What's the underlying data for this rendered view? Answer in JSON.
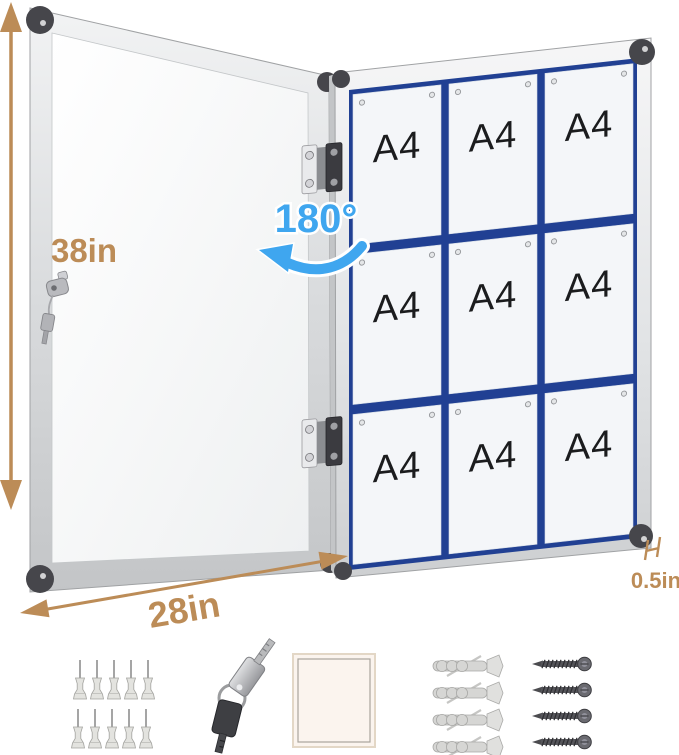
{
  "dimensions": {
    "height_label": "38in",
    "width_label": "28in",
    "depth_label": "0.5in",
    "door_swing_label": "180°"
  },
  "board": {
    "rows": 3,
    "columns": 3,
    "cells": [
      {
        "label": "A4"
      },
      {
        "label": "A4"
      },
      {
        "label": "A4"
      },
      {
        "label": "A4"
      },
      {
        "label": "A4"
      },
      {
        "label": "A4"
      },
      {
        "label": "A4"
      },
      {
        "label": "A4"
      },
      {
        "label": "A4"
      }
    ]
  },
  "accessories": [
    {
      "name": "push-pins",
      "count": 10
    },
    {
      "name": "keys",
      "count": 2
    },
    {
      "name": "adhesive-pad",
      "count": 1
    },
    {
      "name": "wall-anchors",
      "count": 4
    },
    {
      "name": "screws",
      "count": 4
    }
  ],
  "colors": {
    "dimension_labels": "#bc8c57",
    "door_swing_label": "#3fa6ef",
    "board_grid": "#214093",
    "frame": "#d9dbdd",
    "corner_caps": "#46464b",
    "sheets": "#f4f6f9",
    "background": "#ffffff"
  }
}
